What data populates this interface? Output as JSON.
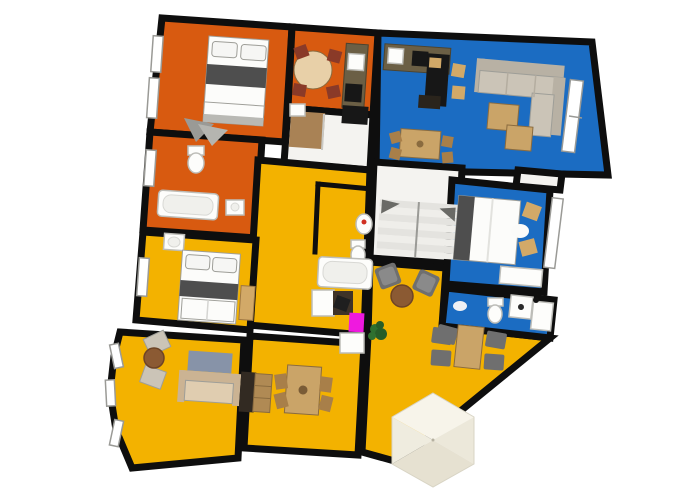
{
  "scene": {
    "description": "3D top-down floor plan render of an apartment with orange, blue and yellow rooms",
    "background": "#ffffff"
  },
  "palette": {
    "wall": "#0e0e0e",
    "floor_orange": "#d85a10",
    "floor_yellow": "#f3b200",
    "floor_blue": "#1b6cc2",
    "floor_white": "#f4f3f0",
    "wood": "#caa468",
    "wood_dark": "#a87f49",
    "wood_light": "#e8d0a8",
    "counter": "#6b5f45",
    "appliance_black": "#171717",
    "chair_red": "#8a3a28",
    "chair_tan": "#d2a968",
    "sofa_seat": "#cbc4b7",
    "sofa_back": "#b8b1a4",
    "sofa_beige": "#e0cdb0",
    "sofa_beige_back": "#cbb393",
    "chair_gray": "#6f6f6f",
    "cushion_gray": "#8a8a8a",
    "bed_band": "#4e4e4e",
    "bed_white": "#fcfcfa",
    "rug_blue": "#8793a8",
    "rug_white": "#fbfbf9",
    "magenta": "#ef19df",
    "plant_green": "#2f7030",
    "plant_green_dark": "#275d28",
    "wardrobe_dark": "#322a22",
    "closet_wood": "#a98255",
    "table_brown": "#8b5a33",
    "shelf_wood": "#b08a54",
    "gray_blanket": "#9a9a96",
    "gray_blanket2": "#b5b5b0",
    "pyramid_base": "#efecdf",
    "pyramid_light": "#f7f4ea",
    "pyramid_mid": "#ece8da",
    "pyramid_dark": "#e6e1d1",
    "red_dot": "#d03022",
    "white_fixture": "#fdfdfb"
  },
  "rooms": [
    {
      "id": "bedroom-top-left",
      "floor": "orange",
      "furniture": [
        "double-bed",
        "windows",
        "folded-blanket"
      ]
    },
    {
      "id": "kitchen-dining-top",
      "floor": "orange",
      "furniture": [
        "round-table",
        "four-chairs",
        "kitchen-counter",
        "sink",
        "stove"
      ]
    },
    {
      "id": "living-room-top-right",
      "floor": "blue",
      "furniture": [
        "kitchen-counter",
        "desk",
        "sectional-sofa",
        "coffee-tables",
        "dining-table",
        "window"
      ]
    },
    {
      "id": "bathroom-left",
      "floor": "orange",
      "furniture": [
        "toilet",
        "bathtub",
        "sink",
        "window"
      ]
    },
    {
      "id": "hallway-closet",
      "floor": "white",
      "furniture": [
        "closet"
      ]
    },
    {
      "id": "bathroom-center",
      "floor": "yellow",
      "furniture": [
        "sink",
        "toilet",
        "bathtub",
        "desk",
        "magenta-cabinet"
      ]
    },
    {
      "id": "staircase",
      "floor": "white",
      "furniture": [
        "stairs"
      ]
    },
    {
      "id": "bedroom-blue",
      "floor": "blue",
      "furniture": [
        "double-bed",
        "armchairs",
        "rug",
        "dresser",
        "window"
      ]
    },
    {
      "id": "bathroom-blue-bottom",
      "floor": "blue",
      "furniture": [
        "toilet",
        "washer",
        "cabinet",
        "rug"
      ]
    },
    {
      "id": "bedroom-yellow-left",
      "floor": "yellow",
      "furniture": [
        "double-bed",
        "sink",
        "wardrobe",
        "window"
      ]
    },
    {
      "id": "sitting-room-bottom-left",
      "floor": "yellow",
      "furniture": [
        "armchairs",
        "round-table",
        "rug",
        "sofa",
        "wardrobe",
        "bay-windows"
      ]
    },
    {
      "id": "dining-room-bottom",
      "floor": "yellow",
      "furniture": [
        "dining-table",
        "four-chairs",
        "bookshelf",
        "white-cabinet"
      ]
    },
    {
      "id": "living-room-yellow-right",
      "floor": "yellow",
      "furniture": [
        "armchairs",
        "round-table",
        "dining-set",
        "plant"
      ]
    }
  ],
  "objects": [
    {
      "id": "hex-roof-pyramid",
      "color": "cream"
    }
  ]
}
